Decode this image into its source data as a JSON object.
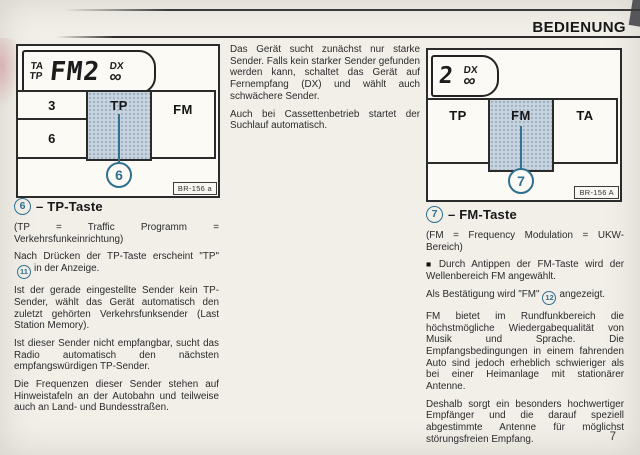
{
  "header": {
    "title": "BEDIENUNG"
  },
  "page_number": "7",
  "figure_left": {
    "display": {
      "indicator_top": "TA",
      "indicator_bottom": "TP",
      "main": "FM2",
      "dx": "DX",
      "infinity": "∞"
    },
    "buttons": {
      "preset_top": "3",
      "preset_bottom": "6",
      "traffic": "TP",
      "band": "FM"
    },
    "callout": "6",
    "figure_label": "BR-156 a"
  },
  "figure_right": {
    "display": {
      "main": "2",
      "dx": "DX",
      "infinity": "∞"
    },
    "buttons": {
      "traffic": "TP",
      "band": "FM",
      "announce": "TA"
    },
    "callout": "7",
    "figure_label": "BR-156 A"
  },
  "middle_column": {
    "paragraphs": [
      "Das Gerät sucht zunächst nur starke Sender. Falls kein starker Sender gefunden werden kann, schaltet das Gerät auf Fernempfang (DX) und wählt auch schwächere Sender.",
      "Auch bei Cassettenbetrieb startet der Suchlauf automatisch."
    ]
  },
  "left_column": {
    "callout": "6",
    "heading": "– TP-Taste",
    "p1": "(TP = Traffic Programm = Verkehrsfunkeinrichtung)",
    "p2_before": "Nach Drücken der TP-Taste erscheint \"TP\"",
    "p2_callout": "11",
    "p2_after": "in der Anzeige.",
    "p3": "Ist der gerade eingestellte Sender kein TP-Sender, wählt das Gerät automatisch den zuletzt gehörten Verkehrsfunksender (Last Station Memory).",
    "p4": "Ist dieser Sender nicht empfangbar, sucht das Radio automatisch den nächsten empfangswürdigen TP-Sender.",
    "p5": "Die Frequenzen dieser Sender stehen auf Hinweistafeln an der Autobahn und teilweise auch an Land- und Bundesstraßen."
  },
  "right_column": {
    "callout": "7",
    "heading": "– FM-Taste",
    "p1": "(FM = Frequency Modulation = UKW-Bereich)",
    "p2_bullet": "■",
    "p2": "Durch Antippen der FM-Taste wird der Wellenbereich FM angewählt.",
    "p3_before": "Als Bestätigung wird \"FM\"",
    "p3_callout": "12",
    "p3_after": "angezeigt.",
    "p4": "FM bietet im Rundfunkbereich die höchstmögliche Wiedergabequalität von Musik und Sprache. Die Empfangsbedingungen in einem fahrenden Auto sind jedoch erheblich schwieriger als bei einer Heimanlage mit stationärer Antenne.",
    "p5": "Deshalb sorgt ein besonders hochwertiger Empfänger und die darauf speziell abgestimmte Antenne für möglichst störungsfreien Empfang."
  }
}
